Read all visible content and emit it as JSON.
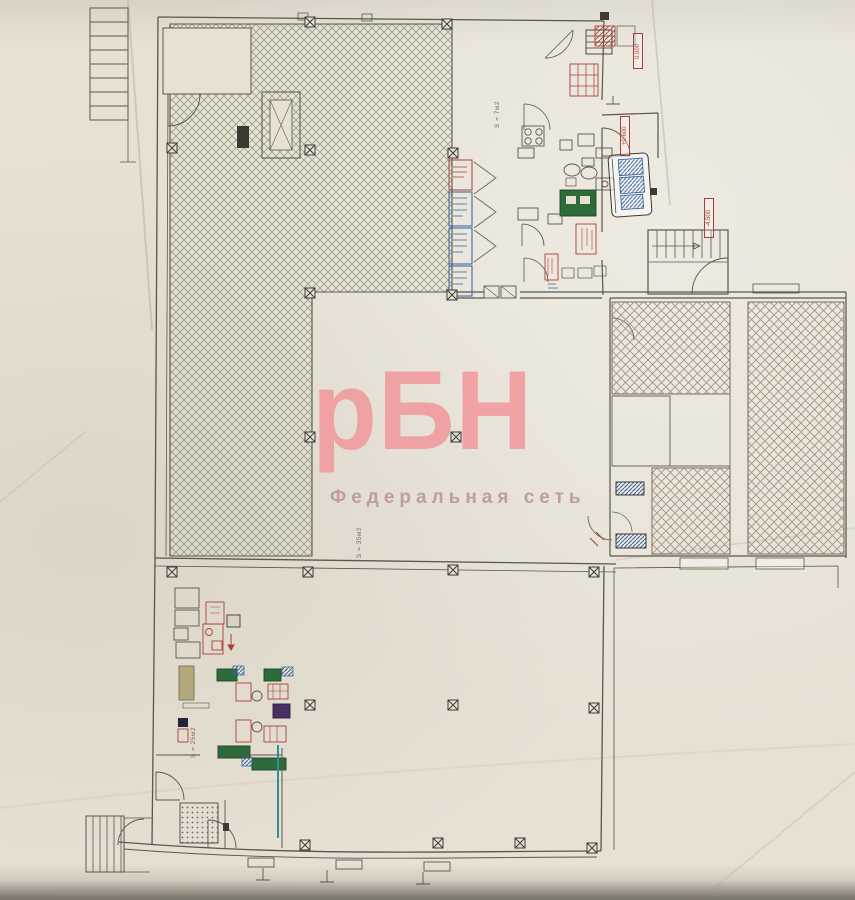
{
  "watermark": {
    "logo": "рБН",
    "subtitle": "Федеральная сеть"
  },
  "labels": {
    "elevation_zero": "0.000",
    "elevation_plus": "+0.600",
    "elevation_minus": "-4.500",
    "area_kitchen": "S = 7м2",
    "area_hall": "S = 35м2",
    "area_service": "S = 25м2"
  },
  "colors": {
    "paper": "#e7e1d4",
    "plan_line": "#5a564b",
    "hatch_green": "#87906e",
    "hatch_brown": "#9a8c7a",
    "accent_red": "#a84038",
    "accent_blue": "#2f5f9e",
    "table_green": "#2e6b3a",
    "equipment_purple": "#4a2f63",
    "watermark_pink": "#f0989d"
  }
}
